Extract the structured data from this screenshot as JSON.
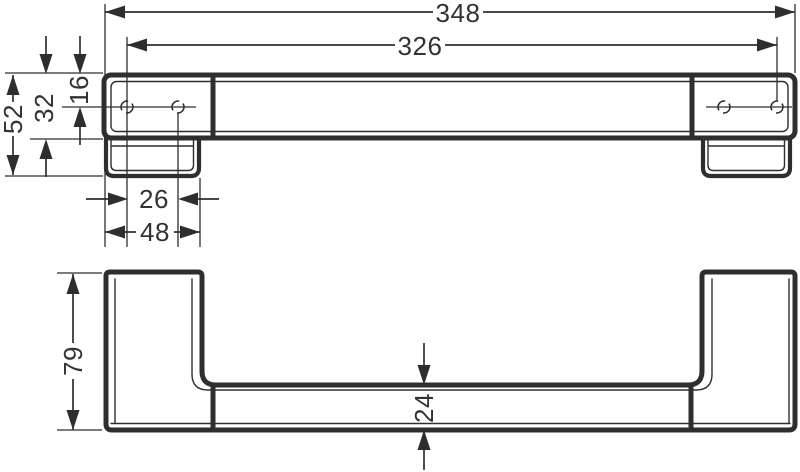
{
  "colors": {
    "line": "#2e2e2e",
    "text": "#333333",
    "background": "#ffffff"
  },
  "drawing": {
    "kind": "technical-dimension-drawing",
    "units": "mm",
    "dims": {
      "overall_width": "348",
      "hole_distance": "326",
      "total_depth": "52",
      "bar_depth": "32",
      "hole_offset": "16",
      "hole_pair_spacing": "26",
      "plate_width": "48",
      "total_height": "79",
      "bar_height": "24"
    }
  }
}
